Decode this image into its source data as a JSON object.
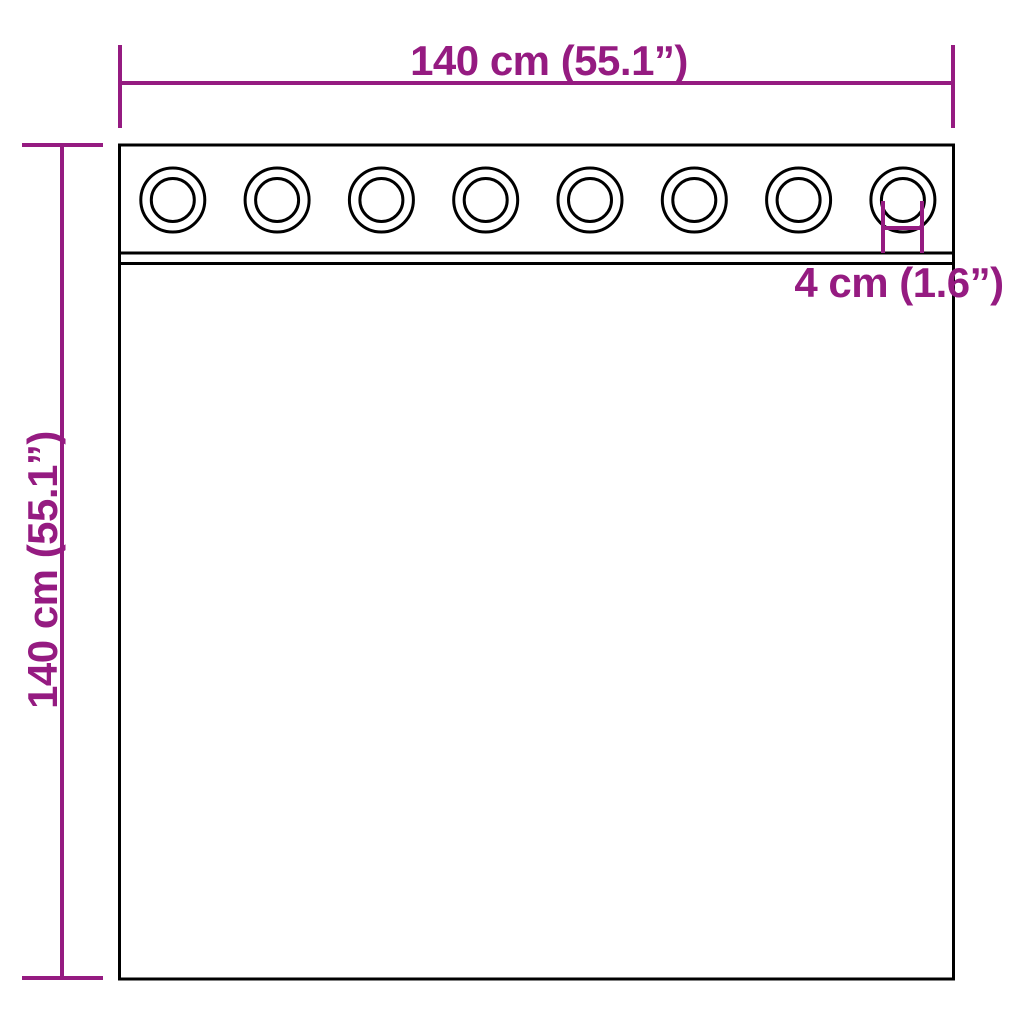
{
  "diagram": {
    "description": "Curtain with grommets - product dimension diagram",
    "colors": {
      "accent": "#951b81",
      "line": "#000000",
      "background": "#ffffff"
    },
    "dimensions": {
      "width_label": "140 cm (55.1”)",
      "height_label": "140 cm (55.1”)",
      "grommet_label": "4 cm (1.6”)"
    },
    "grommets": {
      "count": 8
    }
  }
}
